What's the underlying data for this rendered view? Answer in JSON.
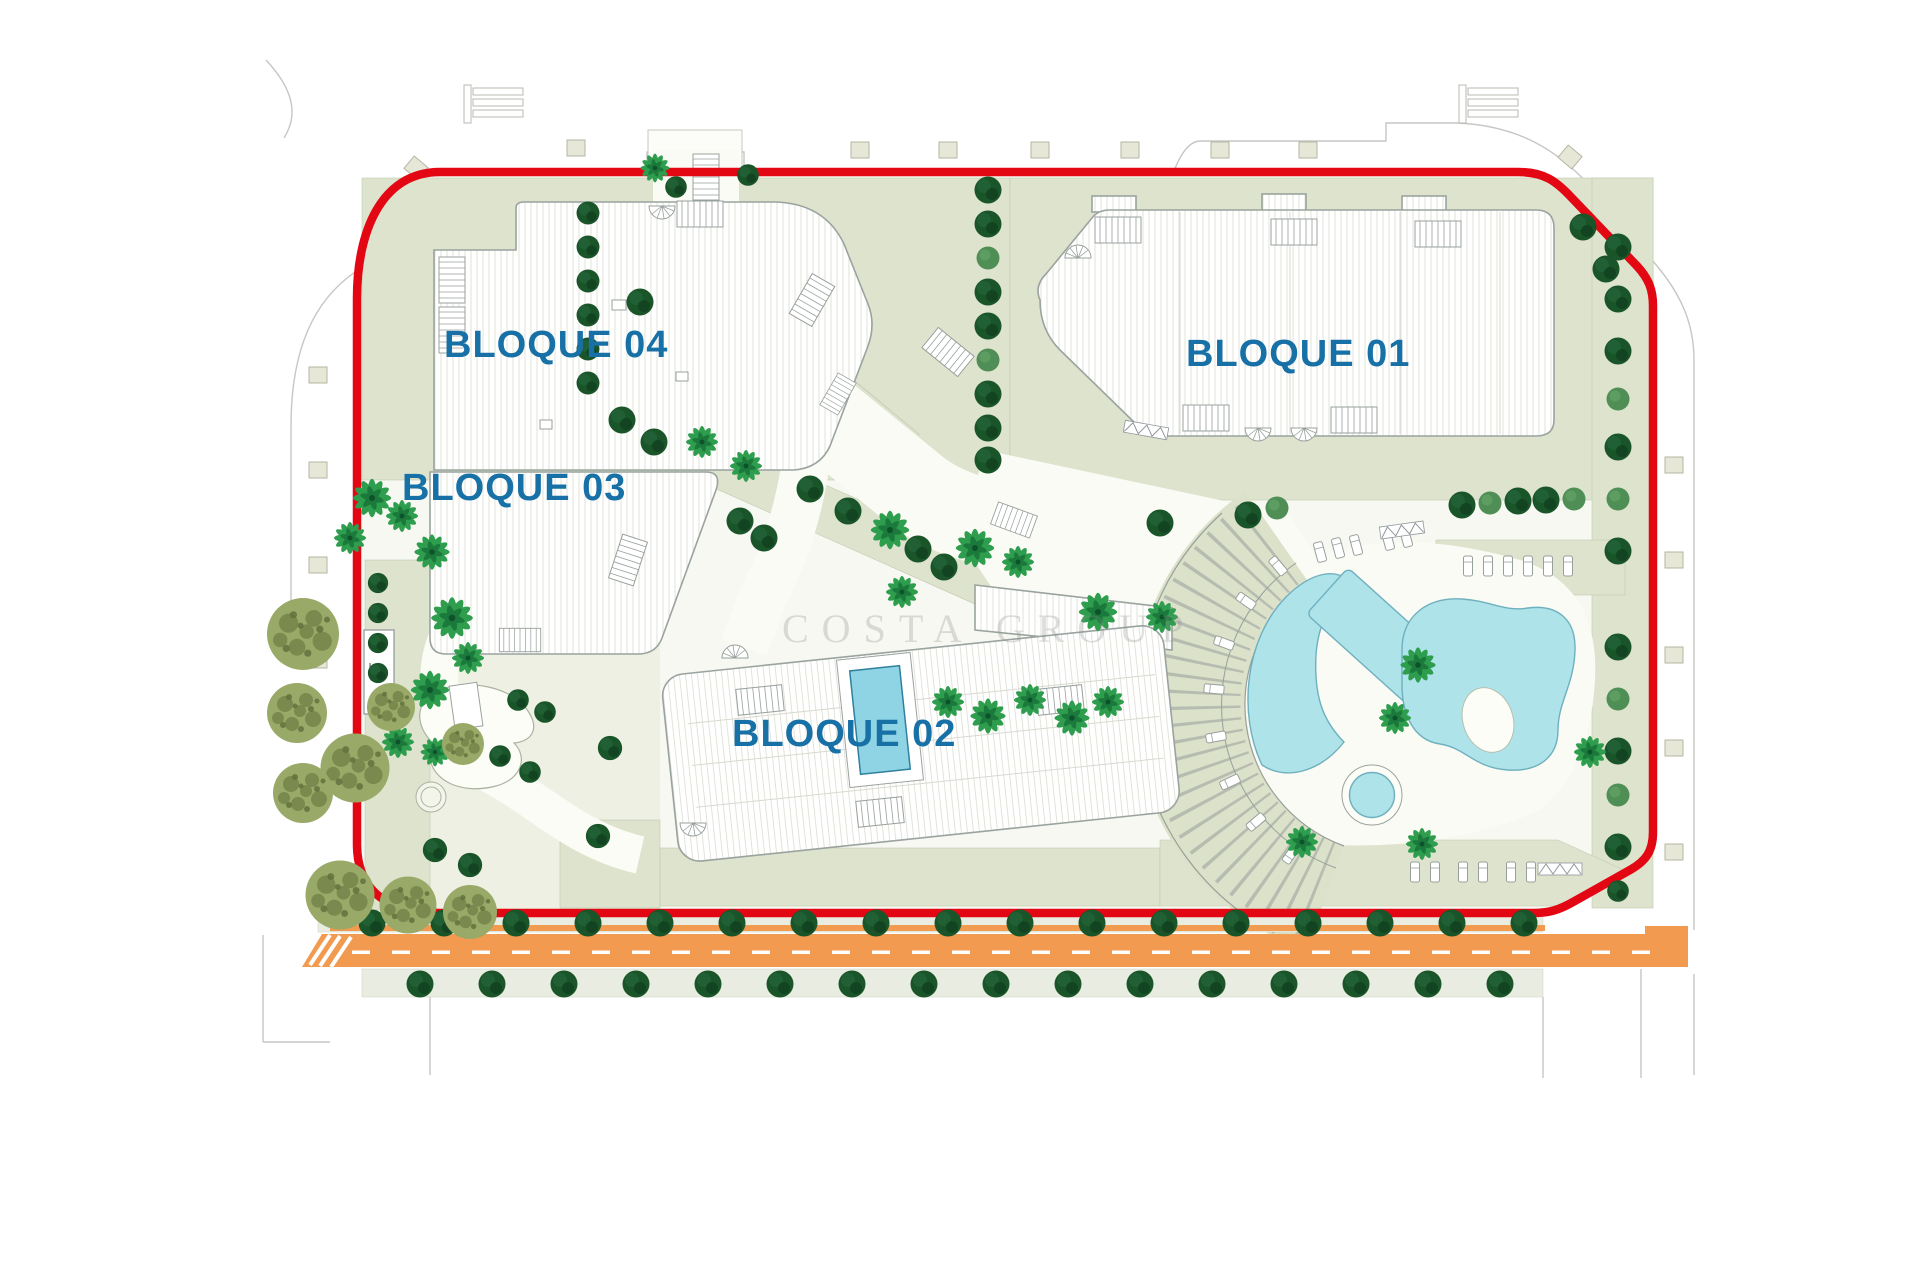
{
  "plan": {
    "blocks": [
      {
        "id": "bloque-01",
        "label": "BLOQUE 01"
      },
      {
        "id": "bloque-02",
        "label": "BLOQUE 02"
      },
      {
        "id": "bloque-03",
        "label": "BLOQUE 03"
      },
      {
        "id": "bloque-04",
        "label": "BLOQUE 04"
      }
    ],
    "utility_label": "CT",
    "watermark": "COSTA GROUP",
    "colors": {
      "boundary_red": "#e30613",
      "block_label_blue": "#1871a6",
      "road_orange": "#f29a50",
      "pool_cyan": "#aee3ea",
      "sage_green": "#dde3cd",
      "tree_dark_green": "#1a5429",
      "palm_green": "#2e9e4e",
      "olive_green": "#99a967"
    }
  }
}
